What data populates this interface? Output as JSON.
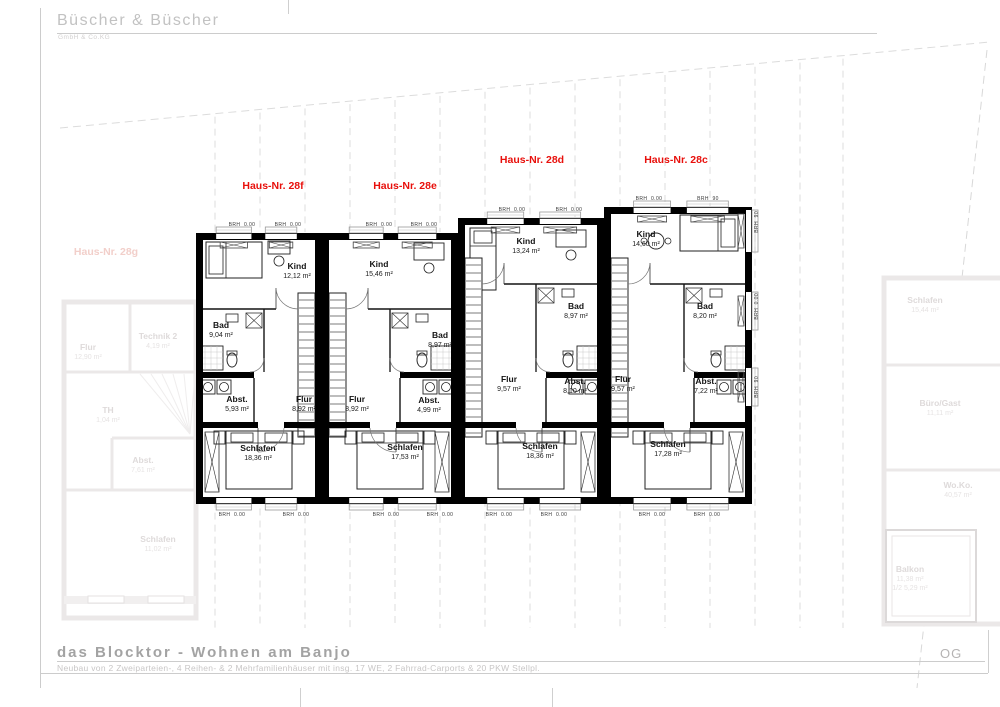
{
  "header": {
    "company": "Büscher & Büscher",
    "company_sub": "GmbH & Co.KG"
  },
  "footer": {
    "project_title": "das Blocktor - Wohnen am Banjo",
    "project_subtitle": "Neubau von 2 Zweiparteien-, 4 Reihen- & 2 Mehrfamilienhäuser mit insg. 17 WE, 2 Fahrrad-Carports & 20 PKW Stellpl.",
    "floor_label": "OG"
  },
  "colors": {
    "house_label_red": "#e8100c",
    "faded_label_pink": "#f2cfca",
    "wall_black": "#000000"
  },
  "houses": [
    {
      "label": "Haus-Nr. 28f",
      "rooms": {
        "kind": {
          "name": "Kind",
          "area": "12,12 m²"
        },
        "bad": {
          "name": "Bad",
          "area": "9,04 m²"
        },
        "abst": {
          "name": "Abst.",
          "area": "5,93 m²"
        },
        "flur": {
          "name": "Flur",
          "area": "8,92 m²"
        },
        "schlafen": {
          "name": "Schlafen",
          "area": "18,36 m²"
        }
      }
    },
    {
      "label": "Haus-Nr. 28e",
      "rooms": {
        "kind": {
          "name": "Kind",
          "area": "15,46 m²"
        },
        "bad": {
          "name": "Bad",
          "area": "8,97 m²"
        },
        "flur": {
          "name": "Flur",
          "area": "8,92 m²"
        },
        "abst": {
          "name": "Abst.",
          "area": "4,99 m²"
        },
        "schlafen": {
          "name": "Schlafen",
          "area": "17,53 m²"
        }
      }
    },
    {
      "label": "Haus-Nr. 28d",
      "rooms": {
        "kind": {
          "name": "Kind",
          "area": "13,24 m²"
        },
        "bad": {
          "name": "Bad",
          "area": "8,97 m²"
        },
        "flur": {
          "name": "Flur",
          "area": "9,57 m²"
        },
        "abst": {
          "name": "Abst.",
          "area": "8,10 m²"
        },
        "schlafen": {
          "name": "Schlafen",
          "area": "18,36 m²"
        }
      }
    },
    {
      "label": "Haus-Nr. 28c",
      "rooms": {
        "kind": {
          "name": "Kind",
          "area": "14,60 m²"
        },
        "bad": {
          "name": "Bad",
          "area": "8,20 m²"
        },
        "flur": {
          "name": "Flur",
          "area": "9,57 m²"
        },
        "abst": {
          "name": "Abst.",
          "area": "7,22 m²"
        },
        "schlafen": {
          "name": "Schlafen",
          "area": "17,28 m²"
        }
      }
    }
  ],
  "adjacent_houses": {
    "left": {
      "label": "Haus-Nr. 28g",
      "rooms": [
        {
          "name": "Flur",
          "area": "12,90 m²"
        },
        {
          "name": "Technik 2",
          "area": "4,19 m²"
        },
        {
          "name": "TH",
          "area": "1,04 m²"
        },
        {
          "name": "Abst.",
          "area": "7,61 m²"
        },
        {
          "name": "Schlafen",
          "area": "11,02 m²"
        }
      ]
    },
    "right": {
      "rooms": [
        {
          "name": "Schlafen",
          "area": "15,44 m²"
        },
        {
          "name": "Büro/Gast",
          "area": "11,11 m²"
        },
        {
          "name": "Wo.Ko.",
          "area": "40,57 m²"
        },
        {
          "name": "Balkon",
          "area": "11,38 m²",
          "area_half": "1/2 5,29 m²"
        }
      ]
    }
  },
  "annotations": {
    "brh_zero": "BRH  0.00",
    "brh_ninety": "BRH  90"
  }
}
